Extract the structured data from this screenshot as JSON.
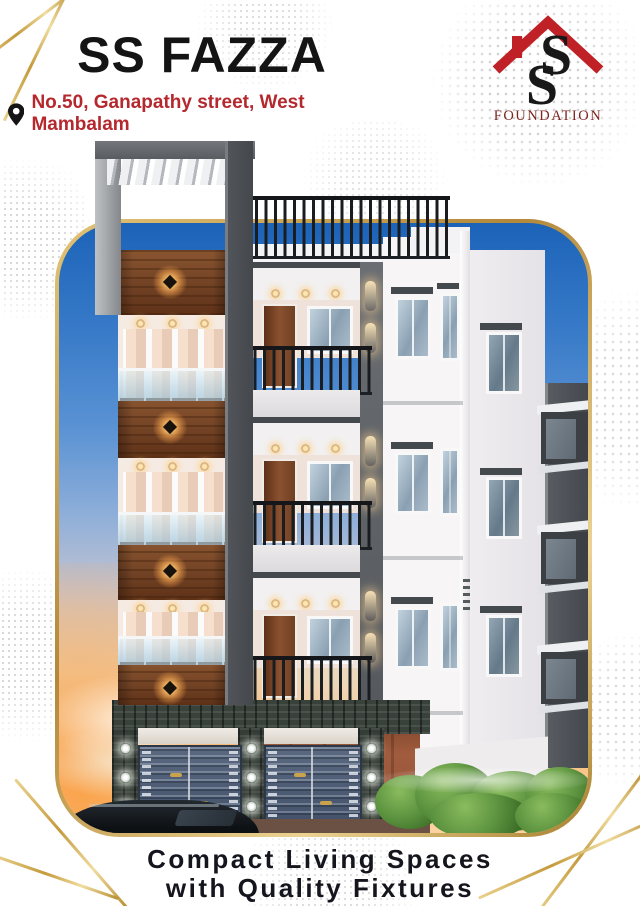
{
  "header": {
    "title": "SS FAZZA",
    "title_color": "#141414",
    "address": "No.50, Ganapathy street, West Mambalam",
    "address_color": "#b5282e",
    "pin_icon": "location-pin"
  },
  "logo": {
    "monogram_s1": "S",
    "monogram_s2": "S",
    "name": "FOUNDATION",
    "roof_icon": "house-roof",
    "roof_color": "#c02126",
    "name_color": "#7d2620"
  },
  "tagline": {
    "line1": "Compact Living Spaces",
    "line2": "with Quality Fixtures"
  },
  "render": {
    "subject": "3D elevation of SS Fazza apartment building at dusk",
    "frame_border_color": "#c9a24b",
    "sky_top_color": "#1c63b8",
    "sunset_color": "#f6c08a",
    "wood_color": "#6f4023",
    "gate_color": "#4b5a70"
  },
  "decor": {
    "dot_color": "#cccccc",
    "gold_line_color": "#c49a3c"
  }
}
